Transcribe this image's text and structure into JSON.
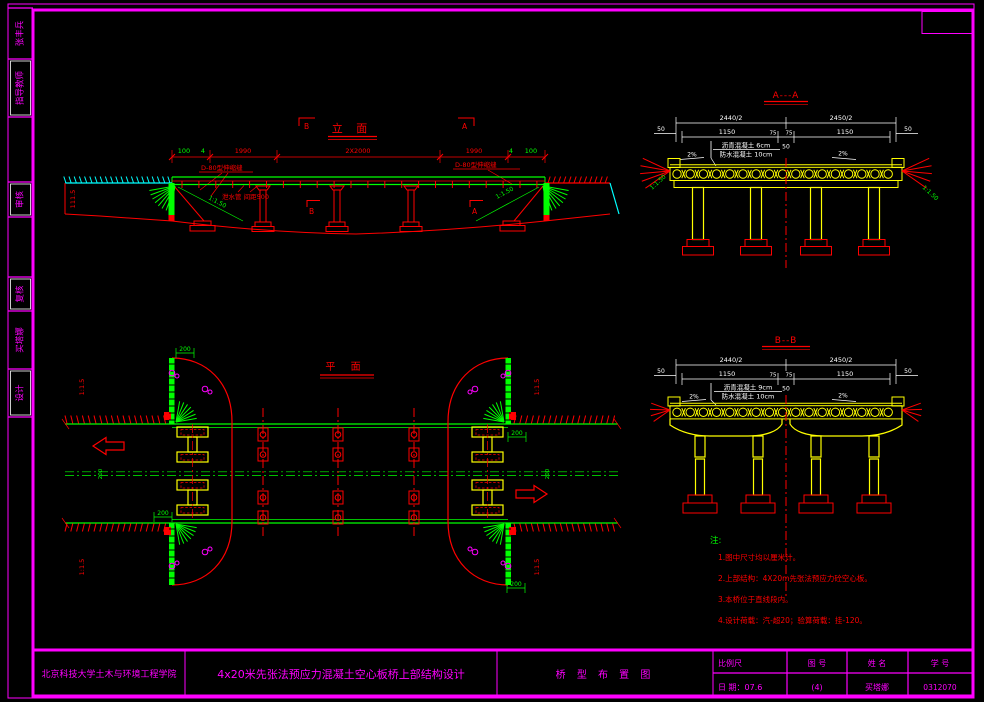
{
  "colors": {
    "frame_magenta": "#FF00FF",
    "line_red": "#FF0000",
    "dim_green": "#00FF00",
    "deck_yellow": "#FFFF00",
    "ground_cyan": "#00FFFF",
    "dim_white": "#FFFFFF"
  },
  "sidebar": {
    "cells": [
      {
        "label": "张丰兵"
      },
      {
        "label": "指导教师"
      },
      {
        "label": "审核"
      },
      {
        "label": "复核"
      },
      {
        "label": "买塔娜"
      },
      {
        "label": "设计"
      }
    ]
  },
  "elevation": {
    "title": "立  面",
    "marker_top_left": "B",
    "marker_top_right": "A",
    "marker_mid_left": "B",
    "marker_mid_right": "A",
    "dims": [
      "100",
      "4",
      "1990",
      "2X2000",
      "1990",
      "4",
      "100"
    ],
    "joint_label_left": "D-80型伸缩缝",
    "joint_label_right": "D-80型伸缩缝",
    "drain_label": "泄水管 间距500",
    "slope_label": "1:1.50",
    "elevation_value": "111.5"
  },
  "section_a": {
    "title": "A---A",
    "dim_half_left": "2440/2",
    "dim_half_right": "2450/2",
    "dim_edge": "50",
    "dim_lane": "1150",
    "dim_median": "75",
    "dim_center": "50",
    "pavement_top": "沥青混凝土 6cm",
    "pavement_bottom": "防水混凝土 10cm",
    "cross_slope": "2%",
    "side_slope": "1:1.50"
  },
  "section_b": {
    "title": "B--B",
    "dim_half_left": "2440/2",
    "dim_half_right": "2450/2",
    "dim_edge": "50",
    "dim_lane": "1150",
    "dim_median": "75",
    "dim_center": "50",
    "pavement_top": "沥青混凝土 9cm",
    "pavement_bottom": "防水混凝土 10cm",
    "cross_slope": "2%"
  },
  "plan": {
    "title": "平  面",
    "slope_label": "1:1.5",
    "offset_dim": "200"
  },
  "notes": {
    "label": "注:",
    "items": [
      "1.图中尺寸均以厘米计。",
      "2.上部结构：4X20m先张法预应力砼空心板。",
      "3.本桥位于直线段内。",
      "4.设计荷载：汽-超20；验算荷载：挂-120。"
    ]
  },
  "title_block": {
    "school": "北京科技大学土木与环境工程学院",
    "project": "4x20米先张法预应力混凝土空心板桥上部结构设计",
    "drawing_name": "桥 型 布 置 图",
    "scale_label": "比例尺",
    "date_label": "日 期：07.6",
    "fig_label": "图  号",
    "fig_value": "(4)",
    "name_label": "姓  名",
    "name_value": "买塔娜",
    "id_label": "学  号",
    "id_value": "0312070"
  }
}
